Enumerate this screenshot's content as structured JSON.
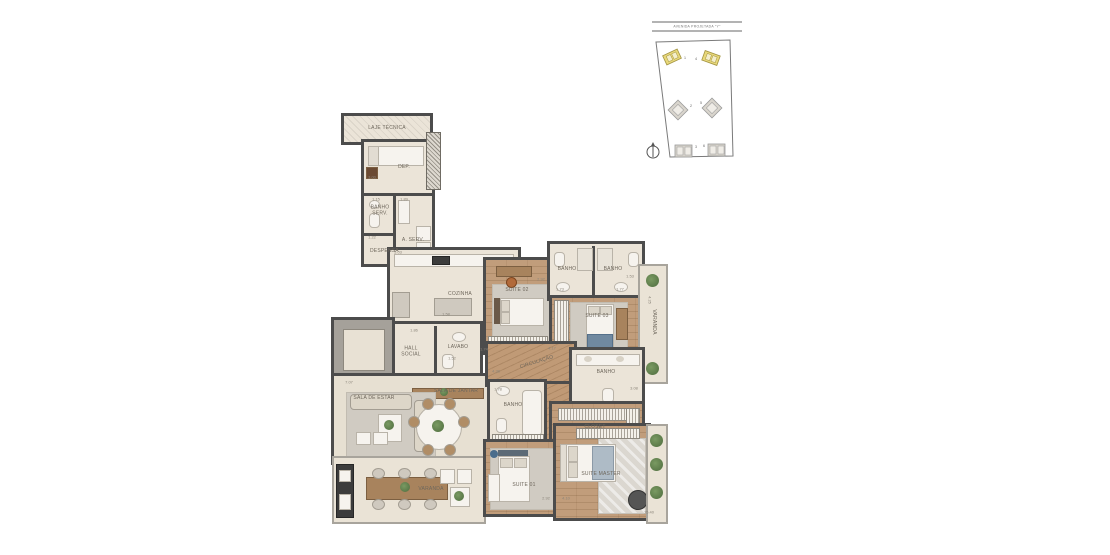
{
  "site_plan": {
    "street_label": "AVENIDA PROJETADA \"Y\"",
    "compass": "north-arrow",
    "buildings": [
      {
        "num": "1",
        "highlighted": true
      },
      {
        "num": "2",
        "highlighted": false
      },
      {
        "num": "3",
        "highlighted": false
      },
      {
        "num": "4",
        "highlighted": true
      },
      {
        "num": "5",
        "highlighted": false
      },
      {
        "num": "6",
        "highlighted": false
      }
    ],
    "colors": {
      "highlight": "#e8d87a",
      "highlight_stroke": "#a39441",
      "normal": "#d9d5cd",
      "normal_stroke": "#9a9a9a",
      "boundary": "#7a7a7a"
    }
  },
  "floor_plan": {
    "colors": {
      "wall": "#4c4c4c",
      "floor_beige": "#ebe4d8",
      "floor_wood": "#c19d7b",
      "rug_gray": "#d0cbc2",
      "plant_green": "#5f7f4c"
    },
    "room_labels": [
      {
        "text": "LAJE TÉCNICA",
        "x": 387,
        "y": 129
      },
      {
        "text": "DEP.",
        "x": 404,
        "y": 168
      },
      {
        "text": "BANHO SERV.",
        "x": 380,
        "y": 211,
        "w": 24
      },
      {
        "text": "A. SERV.",
        "x": 413,
        "y": 241
      },
      {
        "text": "DESPENSA",
        "x": 381,
        "y": 252,
        "w": 22
      },
      {
        "text": "COZINHA",
        "x": 460,
        "y": 295
      },
      {
        "text": "HALL SOCIAL",
        "x": 411,
        "y": 352,
        "w": 28
      },
      {
        "text": "LAVABO",
        "x": 458,
        "y": 348
      },
      {
        "text": "SUITE 02",
        "x": 517,
        "y": 291
      },
      {
        "text": "BANHO",
        "x": 567,
        "y": 270
      },
      {
        "text": "BANHO",
        "x": 613,
        "y": 270
      },
      {
        "text": "SUITE 03",
        "x": 597,
        "y": 317
      },
      {
        "text": "VARANDA",
        "x": 653,
        "y": 322,
        "rot": 90
      },
      {
        "text": "CIRCULAÇÃO",
        "x": 537,
        "y": 363,
        "rot": -17
      },
      {
        "text": "BANHO",
        "x": 513,
        "y": 406
      },
      {
        "text": "BANHO",
        "x": 606,
        "y": 373
      },
      {
        "text": "CLOSET",
        "x": 595,
        "y": 428
      },
      {
        "text": "SALA DE ESTAR",
        "x": 374,
        "y": 399
      },
      {
        "text": "SALA DE JANTAR",
        "x": 456,
        "y": 392
      },
      {
        "text": "VARANDA",
        "x": 431,
        "y": 490
      },
      {
        "text": "SUITE 01",
        "x": 524,
        "y": 486
      },
      {
        "text": "SUITE MASTER",
        "x": 601,
        "y": 475
      }
    ],
    "dimension_labels": [
      {
        "text": "3.00",
        "x": 372,
        "y": 177
      },
      {
        "text": "1.15",
        "x": 376,
        "y": 199
      },
      {
        "text": "1.89",
        "x": 404,
        "y": 199
      },
      {
        "text": "1.22",
        "x": 372,
        "y": 237
      },
      {
        "text": "5.03",
        "x": 398,
        "y": 252
      },
      {
        "text": "1.58",
        "x": 446,
        "y": 314
      },
      {
        "text": "1.86",
        "x": 414,
        "y": 330
      },
      {
        "text": "1.52",
        "x": 452,
        "y": 358
      },
      {
        "text": "1.74",
        "x": 484,
        "y": 349
      },
      {
        "text": "2.92",
        "x": 541,
        "y": 279
      },
      {
        "text": "1.73",
        "x": 560,
        "y": 289
      },
      {
        "text": "1.77",
        "x": 620,
        "y": 289
      },
      {
        "text": "1.53",
        "x": 630,
        "y": 276
      },
      {
        "text": "4.25",
        "x": 650,
        "y": 300,
        "rot": 90
      },
      {
        "text": "4.17",
        "x": 552,
        "y": 348
      },
      {
        "text": "4.38",
        "x": 496,
        "y": 371
      },
      {
        "text": "1.78",
        "x": 498,
        "y": 389
      },
      {
        "text": "3.08",
        "x": 634,
        "y": 388
      },
      {
        "text": "7.07",
        "x": 349,
        "y": 382
      },
      {
        "text": "2.92",
        "x": 546,
        "y": 498
      },
      {
        "text": "4.10",
        "x": 566,
        "y": 498
      },
      {
        "text": "15.40",
        "x": 649,
        "y": 512
      }
    ]
  }
}
